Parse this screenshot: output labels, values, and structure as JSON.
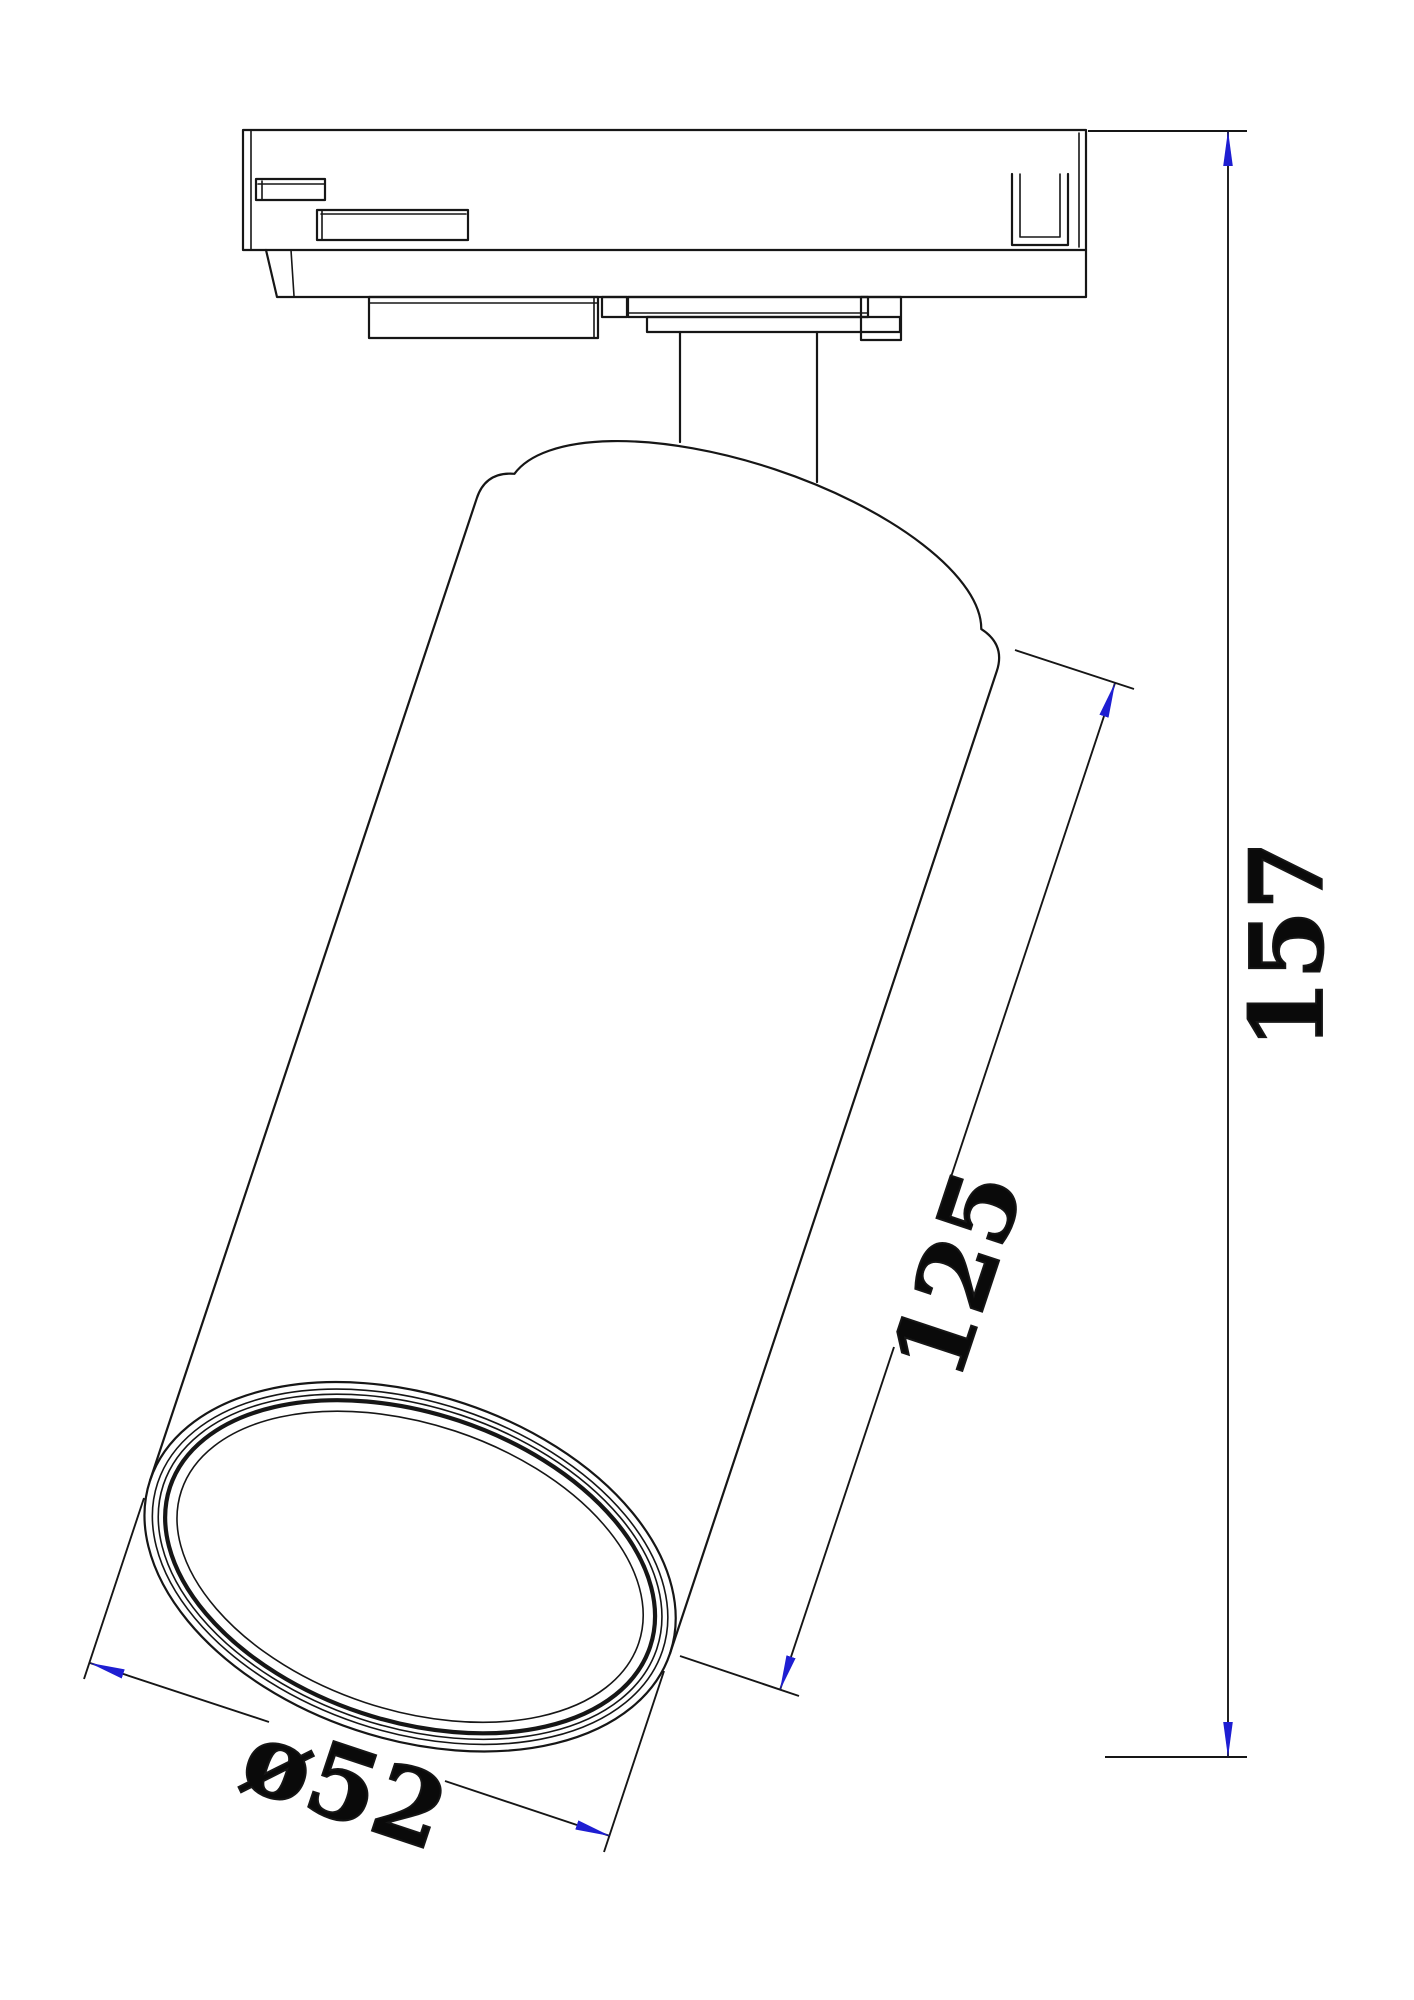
{
  "page": {
    "background_color": "#ffffff"
  },
  "drawing": {
    "description": "Technical dimension line drawing of a track-mounted cylindrical spotlight, side view, tilted cylinder with lens face",
    "line_color": "#161616",
    "arrow_color": "#1e1ed2",
    "dimensions": [
      {
        "id": "overall-height",
        "label": "157"
      },
      {
        "id": "body-length",
        "label": "125"
      },
      {
        "id": "lens-diameter",
        "label": "ø52"
      }
    ]
  }
}
